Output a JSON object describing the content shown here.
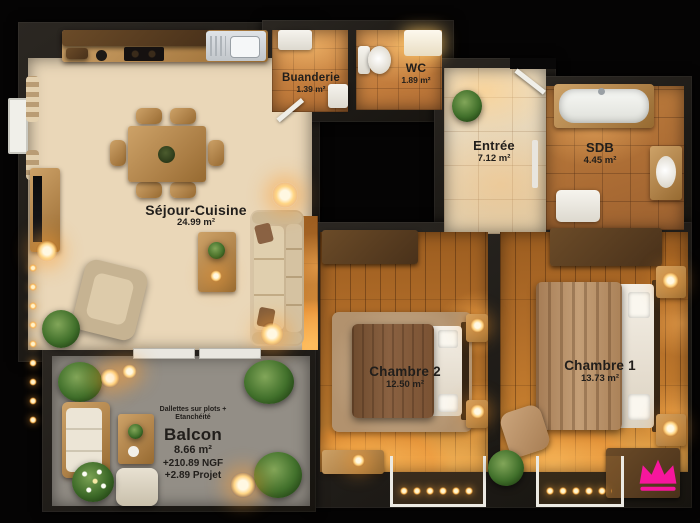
{
  "rooms": {
    "sejour_cuisine": {
      "name": "Séjour-Cuisine",
      "area": "24.99 m²"
    },
    "buanderie": {
      "name": "Buanderie",
      "area": "1.39 m²"
    },
    "wc": {
      "name": "WC",
      "area": "1.89 m²"
    },
    "entree": {
      "name": "Entrée",
      "area": "7.12 m²"
    },
    "sdb": {
      "name": "SDB",
      "area": "4.45 m²"
    },
    "chambre_2": {
      "name": "Chambre 2",
      "area": "12.50 m²"
    },
    "chambre_1": {
      "name": "Chambre 1",
      "area": "13.73 m²"
    },
    "balcon": {
      "name": "Balcon",
      "area": "8.66 m²"
    }
  },
  "balcon_notes": {
    "line1": "Dallettes sur plots +",
    "line2": "Etanchéité",
    "level_ngf": "+210.89 NGF",
    "level_projet": "+2.89 Projet"
  },
  "watermark": {
    "icon": "crown-icon",
    "color": "#f7169d"
  }
}
